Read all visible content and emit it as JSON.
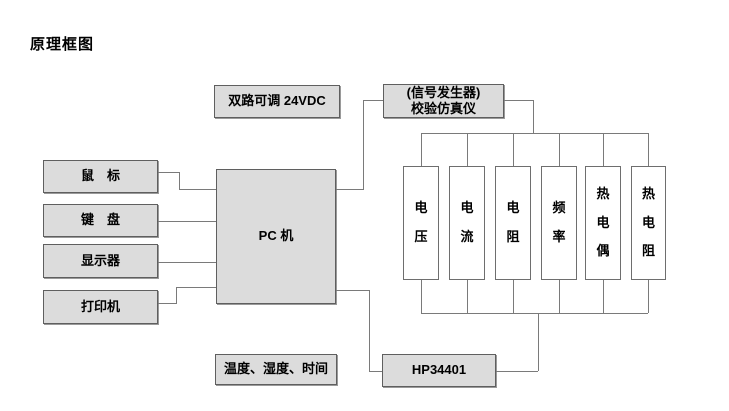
{
  "title": "原理框图",
  "blocks": {
    "psu": {
      "label": "双路可调 24VDC"
    },
    "simulator": {
      "line1": "(信号发生器)",
      "line2": "校验仿真仪"
    },
    "mouse": {
      "label": "鼠　标"
    },
    "keyboard": {
      "label": "键　盘"
    },
    "display": {
      "label": "显示器"
    },
    "printer": {
      "label": "打印机"
    },
    "pc": {
      "label": "PC 机"
    },
    "environment": {
      "label": "温度、湿度、时间"
    },
    "multimeter": {
      "label": "HP34401"
    }
  },
  "channels": [
    {
      "label": "电压"
    },
    {
      "label": "电流"
    },
    {
      "label": "电阻"
    },
    {
      "label": "频率"
    },
    {
      "label": "热电偶"
    },
    {
      "label": "热电阻"
    }
  ],
  "colors": {
    "background": "#ffffff",
    "box_fill": "#dcdcdc",
    "box_border": "#5f5f5f",
    "line": "#7a7a7a",
    "text": "#000000"
  }
}
